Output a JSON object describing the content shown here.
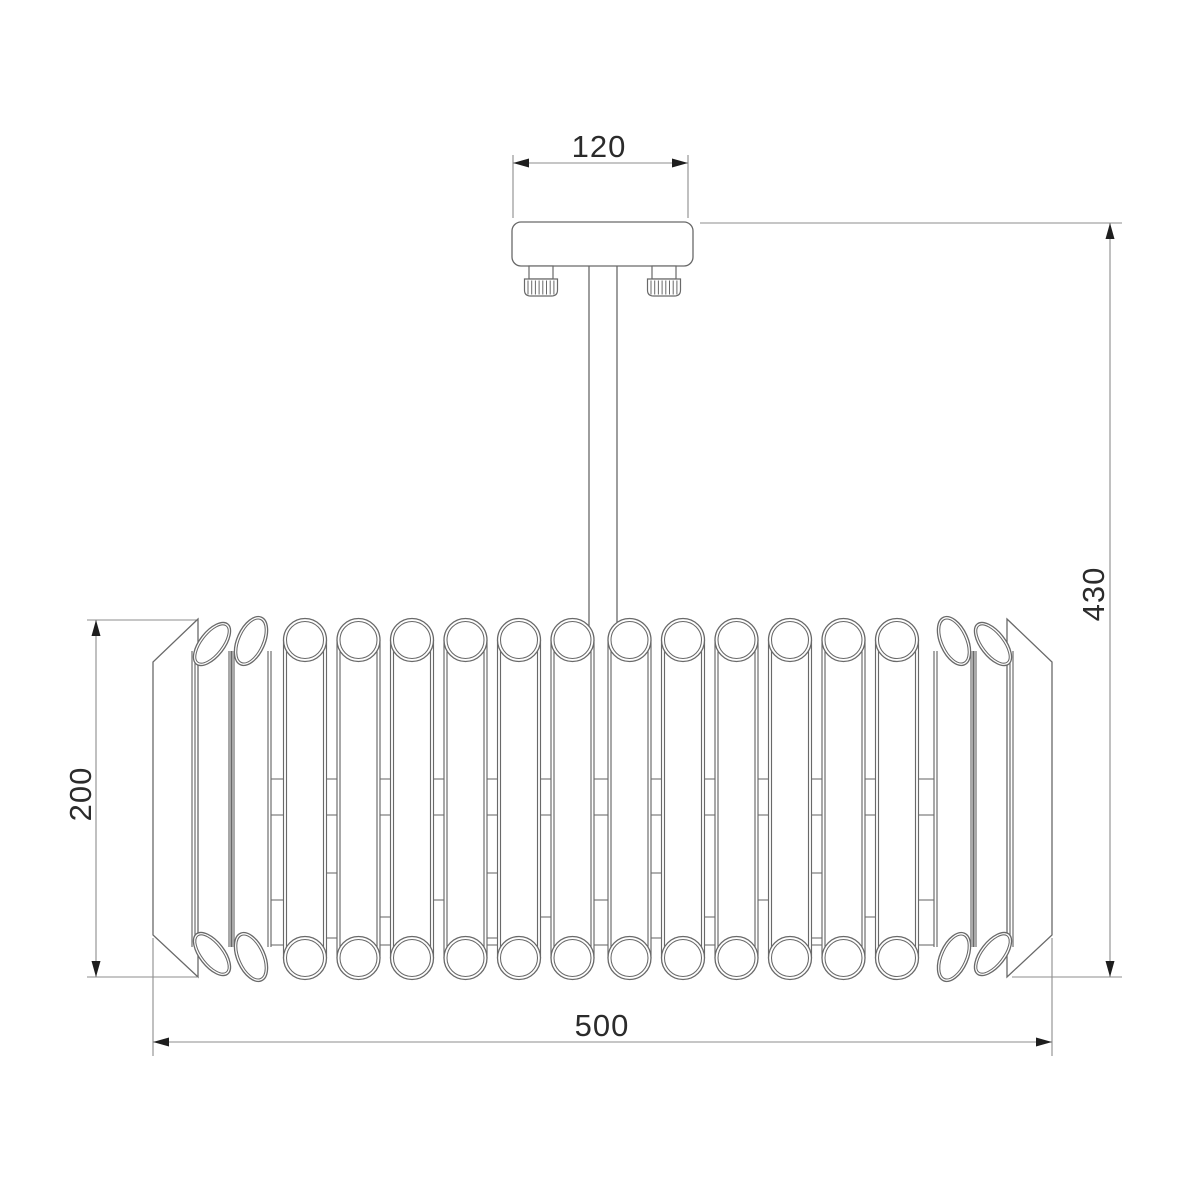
{
  "drawing": {
    "kind": "technical-dimension-drawing",
    "subject": "ceiling chandelier with crystal tube drum shade",
    "dimension_labels": {
      "canopy_width": "120",
      "total_height": "430",
      "shade_height": "200",
      "shade_width": "500"
    },
    "colors": {
      "outline": "#696969",
      "dimension_line": "#8d8d8d",
      "arrow": "#1e1e1e",
      "text": "#2b2b2b",
      "background": "#ffffff"
    },
    "shade": {
      "front_tube_count": 16,
      "tilted_tubes_each_side": 2
    }
  }
}
